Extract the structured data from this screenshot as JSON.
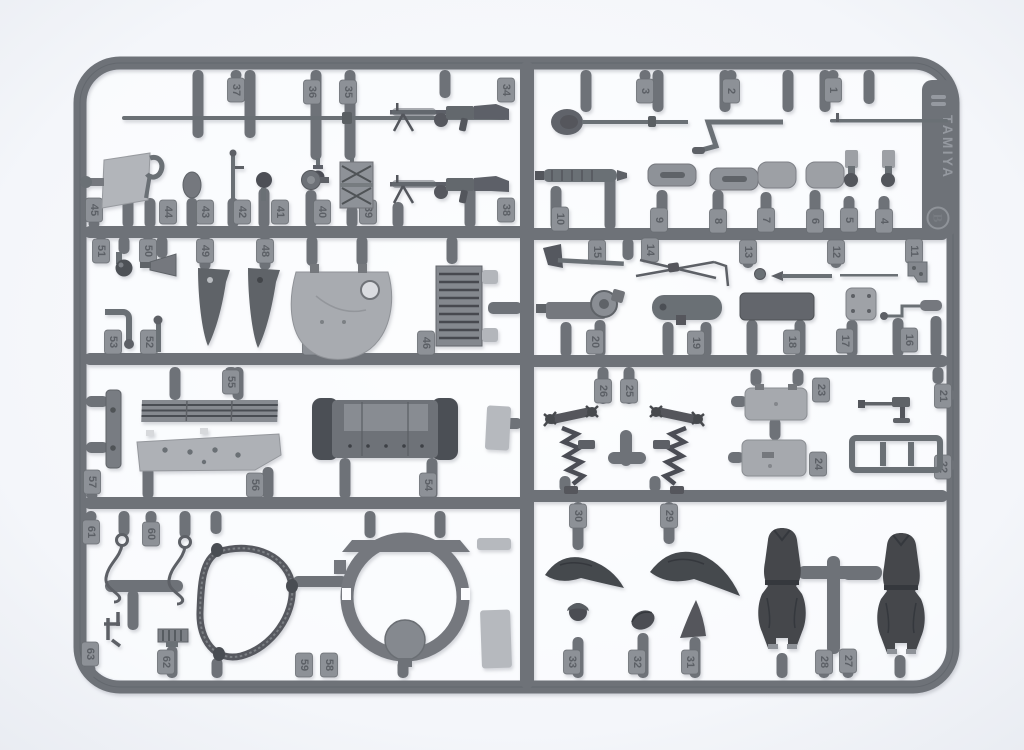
{
  "photo": {
    "subject": "plastic model kit parts sprue (runner) on white background",
    "colors": {
      "plastic": "#6e7278",
      "plastic_dark": "#4b4e54",
      "plastic_light": "#b2b5ba",
      "background": "#f3f5f9"
    }
  },
  "sprue": {
    "brand": "TAMIYA",
    "plate_letter": "B",
    "part_numbers": [
      "37",
      "36",
      "35",
      "34",
      "3",
      "2",
      "1",
      "45",
      "44",
      "43",
      "42",
      "41",
      "40",
      "39",
      "38",
      "10",
      "9",
      "8",
      "7",
      "6",
      "5",
      "4",
      "51",
      "50",
      "49",
      "48",
      "15",
      "14",
      "13",
      "12",
      "11",
      "53",
      "52",
      "47",
      "46",
      "20",
      "19",
      "18",
      "17",
      "16",
      "55",
      "26",
      "25",
      "23",
      "24",
      "21",
      "22",
      "57",
      "56",
      "54",
      "61",
      "60",
      "30",
      "29",
      "63",
      "62",
      "59",
      "58",
      "33",
      "32",
      "31",
      "28",
      "27"
    ]
  }
}
